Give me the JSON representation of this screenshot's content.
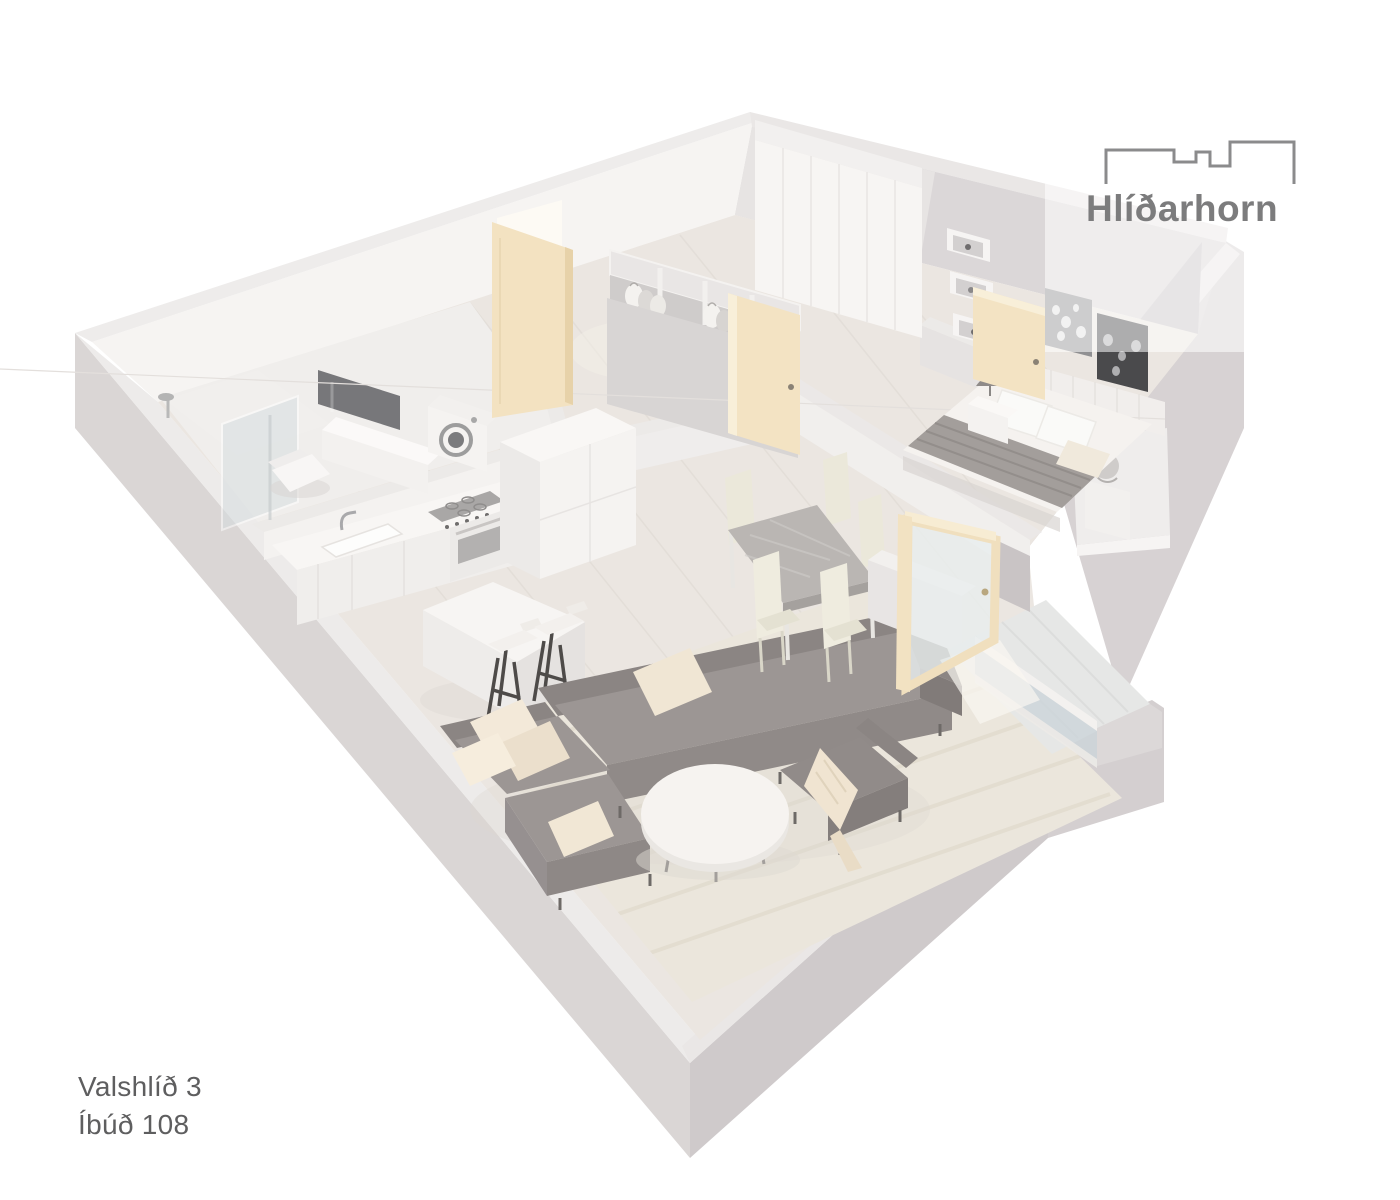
{
  "page": {
    "background": "#ffffff",
    "kind": "3d-apartment-floorplan-render"
  },
  "logo": {
    "text": "Hlíðarhorn",
    "color": "#7c7c7d",
    "icon": "building-skyline-icon"
  },
  "address": {
    "line1": "Valshlíð 3",
    "line2": "Íbúð 108",
    "color": "#5e5e5f"
  },
  "palette": {
    "wall_top": "#ebe8e7",
    "wall_interior_light": "#f6f4f2",
    "wall_interior_shaded": "#cbc6c8",
    "wall_exterior": "#d9d5d4",
    "wall_exterior_dark": "#cfcacb",
    "floor_wood": "#ebe6e1",
    "rug": "#ebe6dc",
    "door_beige": "#f3e3c3",
    "sofa_gray": "#9a9492",
    "cushion_cream": "#f0e6d4",
    "mirror_dark": "#77777a",
    "art_dark": "#4a4a4c",
    "overlay_white": "rgba(255,255,255,0.55)"
  }
}
